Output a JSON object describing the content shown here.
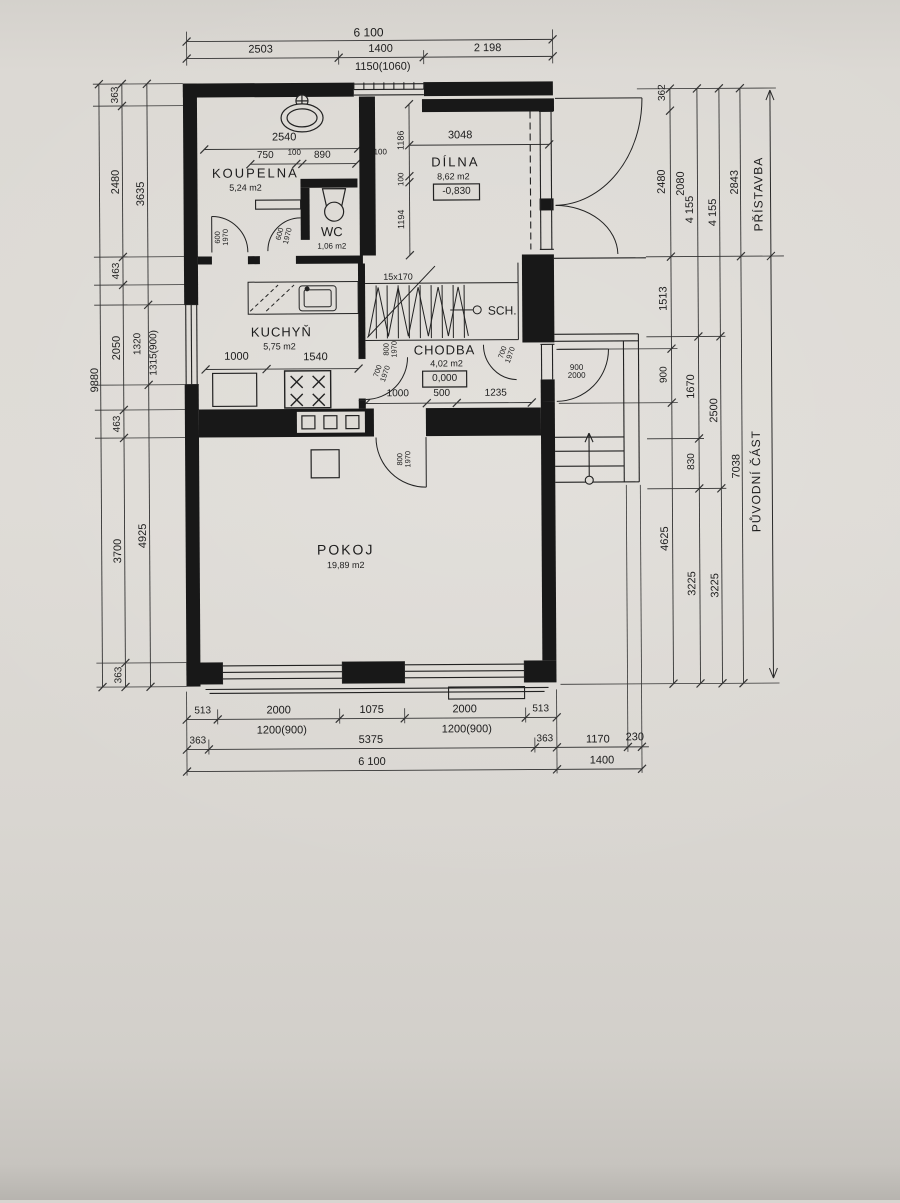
{
  "drawing": {
    "type": "floor plan",
    "overall_width": "6 100",
    "overall_height": "9880",
    "sections": {
      "top": "PŘÍSTAVBA",
      "bottom": "PŮVODNÍ ČÁST"
    },
    "ink_color": "#1d1d1d",
    "paper_color": "#dcd9d4"
  },
  "rooms": [
    {
      "name": "KOUPELNA",
      "area": "5,24 m2"
    },
    {
      "name": "WC",
      "area": "1,06 m2"
    },
    {
      "name": "DÍLNA",
      "area": "8,62 m2",
      "level": "-0,830"
    },
    {
      "name": "KUCHYŇ",
      "area": "5,75 m2"
    },
    {
      "name": "CHODBA",
      "area": "4,02 m2",
      "level": "0,000"
    },
    {
      "name": "POKOJ",
      "area": "19,89 m2"
    },
    {
      "name": "SCH.",
      "stairs_spec": "15x170"
    }
  ],
  "labels": [
    {
      "id": "dim-overall-width",
      "t": "6 100",
      "x": 372,
      "y": 32,
      "fs": 12
    },
    {
      "id": "dim",
      "t": "2503",
      "x": 264,
      "y": 49,
      "fs": 11
    },
    {
      "id": "dim",
      "t": "1400",
      "x": 384,
      "y": 49,
      "fs": 11
    },
    {
      "id": "dim",
      "t": "2 198",
      "x": 491,
      "y": 49,
      "fs": 11
    },
    {
      "id": "dim-window",
      "t": "1150(1060)",
      "x": 386,
      "y": 67,
      "fs": 11
    },
    {
      "id": "dim",
      "t": "2540",
      "x": 287,
      "y": 137,
      "fs": 11
    },
    {
      "id": "dim",
      "t": "750",
      "x": 268,
      "y": 155,
      "fs": 10
    },
    {
      "id": "dim",
      "t": "100",
      "x": 297,
      "y": 152,
      "fs": 8
    },
    {
      "id": "dim",
      "t": "890",
      "x": 325,
      "y": 155,
      "fs": 10
    },
    {
      "id": "dim",
      "t": "3048",
      "x": 463,
      "y": 136,
      "fs": 11
    },
    {
      "id": "dim",
      "t": "100",
      "x": 383,
      "y": 152,
      "fs": 8
    },
    {
      "id": "dim",
      "t": "1186",
      "x": 404,
      "y": 140,
      "fs": 9,
      "r": -90
    },
    {
      "id": "dim",
      "t": "100",
      "x": 404,
      "y": 179,
      "fs": 8,
      "r": -90
    },
    {
      "id": "dim",
      "t": "1194",
      "x": 404,
      "y": 219,
      "fs": 9,
      "r": -90
    },
    {
      "id": "room-label-koupelna",
      "t": "KOUPELNA",
      "x": 258,
      "y": 172,
      "fs": 13,
      "ls": 2
    },
    {
      "id": "room-area-koupelna",
      "t": "5,24 m2",
      "x": 248,
      "y": 187,
      "fs": 9
    },
    {
      "id": "room-label-wc",
      "t": "WC",
      "x": 334,
      "y": 231,
      "fs": 13
    },
    {
      "id": "room-area-wc",
      "t": "1,06 m2",
      "x": 334,
      "y": 246,
      "fs": 8
    },
    {
      "id": "room-label-dilna",
      "t": "DÍLNA",
      "x": 458,
      "y": 162,
      "fs": 13,
      "ls": 2
    },
    {
      "id": "room-area-dilna",
      "t": "8,62 m2",
      "x": 456,
      "y": 177,
      "fs": 9
    },
    {
      "id": "level-dilna",
      "t": "-0,830",
      "x": 459,
      "y": 192,
      "fs": 10
    },
    {
      "id": "room-label-kuchyn",
      "t": "KUCHYŇ",
      "x": 283,
      "y": 331,
      "fs": 13,
      "ls": 1
    },
    {
      "id": "room-area-kuchyn",
      "t": "5,75 m2",
      "x": 281,
      "y": 346,
      "fs": 9
    },
    {
      "id": "room-label-chodba",
      "t": "CHODBA",
      "x": 446,
      "y": 350,
      "fs": 13,
      "ls": 1
    },
    {
      "id": "room-area-chodba",
      "t": "4,02 m2",
      "x": 448,
      "y": 364,
      "fs": 9
    },
    {
      "id": "level-chodba",
      "t": "0,000",
      "x": 446,
      "y": 379,
      "fs": 10
    },
    {
      "id": "room-label-pokoj",
      "t": "POKOJ",
      "x": 346,
      "y": 549,
      "fs": 14,
      "ls": 2
    },
    {
      "id": "room-area-pokoj",
      "t": "19,89 m2",
      "x": 346,
      "y": 565,
      "fs": 9
    },
    {
      "id": "room-label-sch",
      "t": "SCH.",
      "x": 504,
      "y": 311,
      "fs": 12
    },
    {
      "id": "stairs-spec",
      "t": "15x170",
      "x": 400,
      "y": 277,
      "fs": 9
    },
    {
      "id": "dim",
      "t": "1000",
      "x": 238,
      "y": 356,
      "fs": 11
    },
    {
      "id": "dim",
      "t": "1540",
      "x": 317,
      "y": 357,
      "fs": 11
    },
    {
      "id": "dim",
      "t": "1000",
      "x": 399,
      "y": 394,
      "fs": 10
    },
    {
      "id": "dim",
      "t": "500",
      "x": 443,
      "y": 394,
      "fs": 10
    },
    {
      "id": "dim",
      "t": "1235",
      "x": 497,
      "y": 394,
      "fs": 10
    },
    {
      "id": "door-size",
      "t": "600|1970",
      "x": 224,
      "y": 236,
      "fs": 7.5,
      "r": -90
    },
    {
      "id": "door-size",
      "t": "600|1970",
      "x": 286,
      "y": 234,
      "fs": 7.5,
      "r": -75
    },
    {
      "id": "door-size",
      "t": "800|1970",
      "x": 392,
      "y": 349,
      "fs": 7.5,
      "r": -90
    },
    {
      "id": "door-size",
      "t": "700|1970",
      "x": 383,
      "y": 372,
      "fs": 7.5,
      "r": -70
    },
    {
      "id": "door-size",
      "t": "700|1970",
      "x": 508,
      "y": 354,
      "fs": 7.5,
      "r": -70
    },
    {
      "id": "door-size",
      "t": "900|2000",
      "x": 578,
      "y": 373,
      "fs": 8
    },
    {
      "id": "door-size",
      "t": "800|1970",
      "x": 405,
      "y": 459,
      "fs": 7.5,
      "r": -90
    },
    {
      "id": "dim-overall-height",
      "t": "9880",
      "x": 97,
      "y": 378,
      "fs": 11,
      "r": -90
    },
    {
      "id": "dim",
      "t": "363",
      "x": 119,
      "y": 93,
      "fs": 10,
      "r": -90
    },
    {
      "id": "dim",
      "t": "2480",
      "x": 119,
      "y": 180,
      "fs": 11,
      "r": -90
    },
    {
      "id": "dim",
      "t": "463",
      "x": 119,
      "y": 269,
      "fs": 10,
      "r": -90
    },
    {
      "id": "dim",
      "t": "2050",
      "x": 119,
      "y": 346,
      "fs": 11,
      "r": -90
    },
    {
      "id": "dim",
      "t": "463",
      "x": 119,
      "y": 422,
      "fs": 10,
      "r": -90
    },
    {
      "id": "dim",
      "t": "3700",
      "x": 119,
      "y": 549,
      "fs": 11,
      "r": -90
    },
    {
      "id": "dim",
      "t": "363",
      "x": 119,
      "y": 673,
      "fs": 10,
      "r": -90
    },
    {
      "id": "dim",
      "t": "3635",
      "x": 144,
      "y": 192,
      "fs": 11,
      "r": -90
    },
    {
      "id": "dim",
      "t": "1320",
      "x": 140,
      "y": 342,
      "fs": 10,
      "r": -90
    },
    {
      "id": "dim-window",
      "t": "1315(900)",
      "x": 156,
      "y": 351,
      "fs": 10,
      "r": -90
    },
    {
      "id": "dim",
      "t": "4925",
      "x": 144,
      "y": 534,
      "fs": 11,
      "r": -90
    },
    {
      "id": "dim",
      "t": "362",
      "x": 666,
      "y": 94,
      "fs": 10,
      "r": -90
    },
    {
      "id": "dim",
      "t": "2480",
      "x": 665,
      "y": 183,
      "fs": 11,
      "r": -90
    },
    {
      "id": "dim",
      "t": "2080",
      "x": 684,
      "y": 185,
      "fs": 11,
      "r": -90
    },
    {
      "id": "dim",
      "t": "1513",
      "x": 666,
      "y": 300,
      "fs": 11,
      "r": -90
    },
    {
      "id": "dim",
      "t": "900",
      "x": 666,
      "y": 376,
      "fs": 10,
      "r": -90
    },
    {
      "id": "dim",
      "t": "4625",
      "x": 666,
      "y": 540,
      "fs": 11,
      "r": -90
    },
    {
      "id": "dim",
      "t": "4 155",
      "x": 693,
      "y": 211,
      "fs": 11,
      "r": -90
    },
    {
      "id": "dim",
      "t": "1670",
      "x": 693,
      "y": 388,
      "fs": 11,
      "r": -90
    },
    {
      "id": "dim",
      "t": "830",
      "x": 693,
      "y": 463,
      "fs": 10,
      "r": -90
    },
    {
      "id": "dim",
      "t": "3225",
      "x": 693,
      "y": 585,
      "fs": 11,
      "r": -90
    },
    {
      "id": "dim",
      "t": "4 155",
      "x": 716,
      "y": 214,
      "fs": 11,
      "r": -90
    },
    {
      "id": "dim",
      "t": "2500",
      "x": 716,
      "y": 412,
      "fs": 11,
      "r": -90
    },
    {
      "id": "dim",
      "t": "3225",
      "x": 716,
      "y": 587,
      "fs": 11,
      "r": -90
    },
    {
      "id": "dim",
      "t": "2843",
      "x": 738,
      "y": 184,
      "fs": 11,
      "r": -90
    },
    {
      "id": "dim",
      "t": "7038",
      "x": 738,
      "y": 468,
      "fs": 11,
      "r": -90
    },
    {
      "id": "annotation-pristavba",
      "t": "PŘÍSTAVBA",
      "x": 761,
      "y": 196,
      "fs": 12,
      "r": -90,
      "ls": 1
    },
    {
      "id": "annotation-puvodni-cast",
      "t": "PŮVODNÍ ČÁST",
      "x": 757,
      "y": 483,
      "fs": 12,
      "r": -90,
      "ls": 1
    },
    {
      "id": "dim",
      "t": "513",
      "x": 202,
      "y": 710,
      "fs": 10
    },
    {
      "id": "dim",
      "t": "2000",
      "x": 278,
      "y": 710,
      "fs": 11
    },
    {
      "id": "dim",
      "t": "1075",
      "x": 371,
      "y": 710,
      "fs": 11
    },
    {
      "id": "dim",
      "t": "2000",
      "x": 464,
      "y": 710,
      "fs": 11
    },
    {
      "id": "dim",
      "t": "513",
      "x": 540,
      "y": 710,
      "fs": 10
    },
    {
      "id": "dim-window",
      "t": "1200(900)",
      "x": 281,
      "y": 730,
      "fs": 11
    },
    {
      "id": "dim-window",
      "t": "1200(900)",
      "x": 466,
      "y": 730,
      "fs": 11
    },
    {
      "id": "dim",
      "t": "363",
      "x": 197,
      "y": 740,
      "fs": 10
    },
    {
      "id": "dim",
      "t": "5375",
      "x": 370,
      "y": 740,
      "fs": 11
    },
    {
      "id": "dim",
      "t": "363",
      "x": 544,
      "y": 740,
      "fs": 10
    },
    {
      "id": "dim",
      "t": "1170",
      "x": 597,
      "y": 741,
      "fs": 11
    },
    {
      "id": "dim",
      "t": "230",
      "x": 634,
      "y": 739,
      "fs": 11
    },
    {
      "id": "dim",
      "t": "6 100",
      "x": 371,
      "y": 762,
      "fs": 11
    },
    {
      "id": "dim",
      "t": "1400",
      "x": 601,
      "y": 762,
      "fs": 11
    }
  ]
}
